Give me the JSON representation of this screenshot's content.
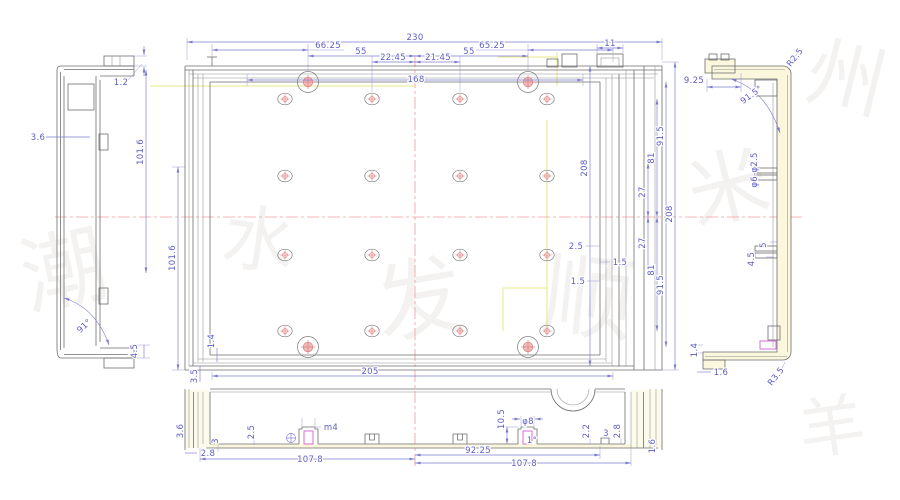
{
  "drawing_type": "CAD engineering drawing - extruded enclosure profile, four views",
  "colors": {
    "dimension": "#5d5dc4",
    "object_line": "#6e6e6e",
    "centerline": "#f49c9c",
    "construction": "#e9e986",
    "section_fill": "#faf7dd",
    "highlight": "#d45fd0"
  },
  "tv": {
    "w230": "230",
    "d6625": "66.25",
    "d55l": "55",
    "d2245": "22.45",
    "d2145": "21.45",
    "d55r": "55",
    "d6525": "65.25",
    "d168": "168",
    "d11": "11",
    "h1016": "101.6",
    "d14": "1.4",
    "d35": "3.5",
    "d205": "205",
    "d915t": "91.5",
    "d81t": "81",
    "d27t": "27",
    "d27b": "27",
    "d81b": "81",
    "d915b": "91.5",
    "d208i": "208",
    "d208o": "208",
    "d25": "2.5",
    "d15a": "1.5",
    "d15b": "1.5"
  },
  "lv": {
    "d12": "1.2",
    "d36": "3.6",
    "d1016": "101.6",
    "a91": "91°",
    "d45": "4.5"
  },
  "rv": {
    "d925": "9.25",
    "r25": "R2.5",
    "a915": "91.5°",
    "phi": "φ6-φ2.5",
    "d5": "5",
    "d45": "4.5",
    "d14": "1.4",
    "d16": "1.6",
    "r35": "R3.5"
  },
  "bv": {
    "d36": "3.6",
    "d3l": "3",
    "d25": "2.5",
    "d28l": "2.8",
    "d1078l": "107.8",
    "m4": "m4",
    "d105": "10.5",
    "phi8": "φ8",
    "a1": "1°",
    "d9225": "92.25",
    "d1078r": "107.8",
    "d22": "2.2",
    "d3r": "3",
    "d28r": "2.8",
    "d16": "1.6"
  },
  "wm": [
    "潮",
    "水",
    "发",
    "顺",
    "米",
    "州",
    "羊"
  ]
}
